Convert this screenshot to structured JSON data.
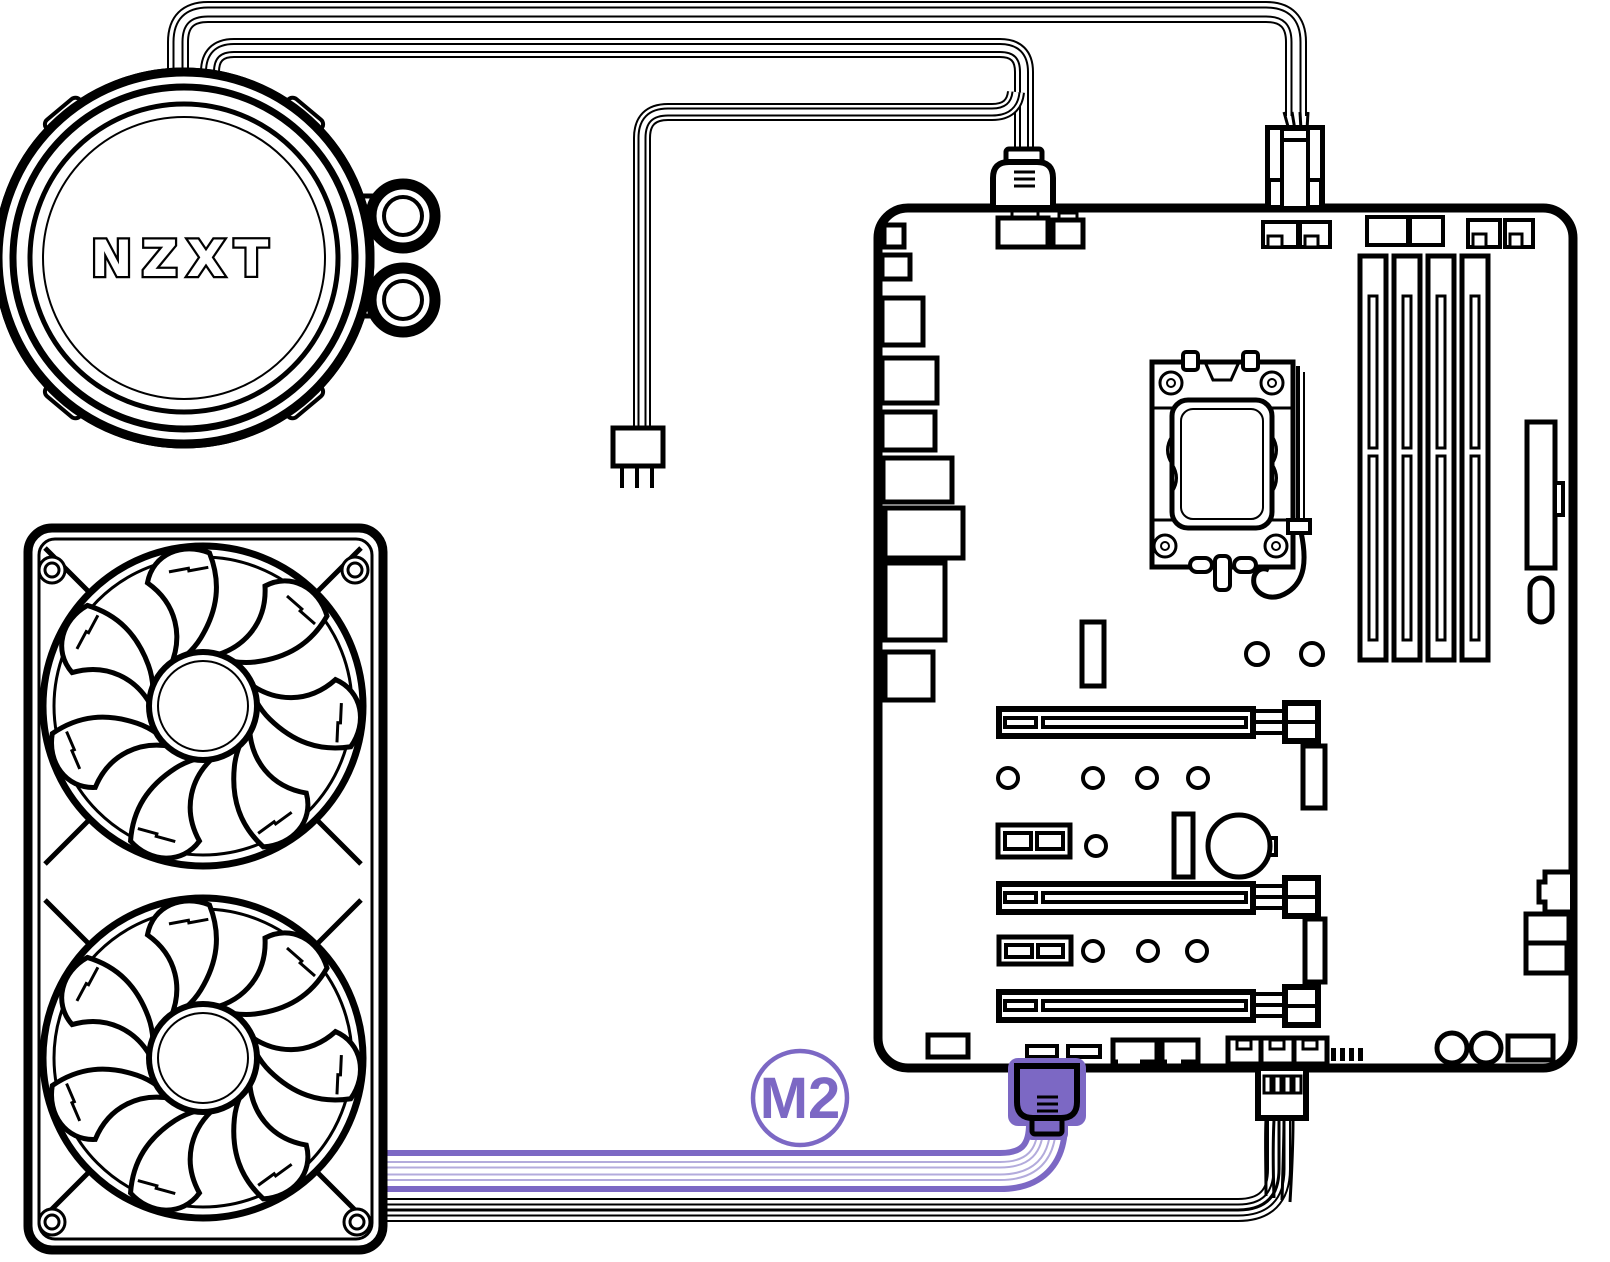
{
  "diagram": {
    "labels": {
      "pump_logo": "NZXT",
      "cable_badge": "M2"
    },
    "colors": {
      "accent_purple": "#7C68C4",
      "accent_purple_light": "#D9D4EE",
      "accent_purple_tint": "#B3ABDC",
      "line_black": "#000000",
      "background": "#FFFFFF"
    },
    "components": {
      "pump": "aio-pump-head",
      "pump_fittings": 2,
      "radiator": "dual-fan-radiator",
      "fan_count": 2,
      "fan_blades_per_fan": 7,
      "motherboard": "atx-motherboard",
      "ram_slots": 4,
      "pcie_x16_slots": 3,
      "pcie_x1_slots": 2,
      "cables": [
        "pump-fan-header-cable",
        "pump-usb-header-cable",
        "pump-3pin-connector-dangling",
        "radiator-usb-cable-highlighted-m2",
        "radiator-4pin-fan-cable"
      ]
    }
  }
}
